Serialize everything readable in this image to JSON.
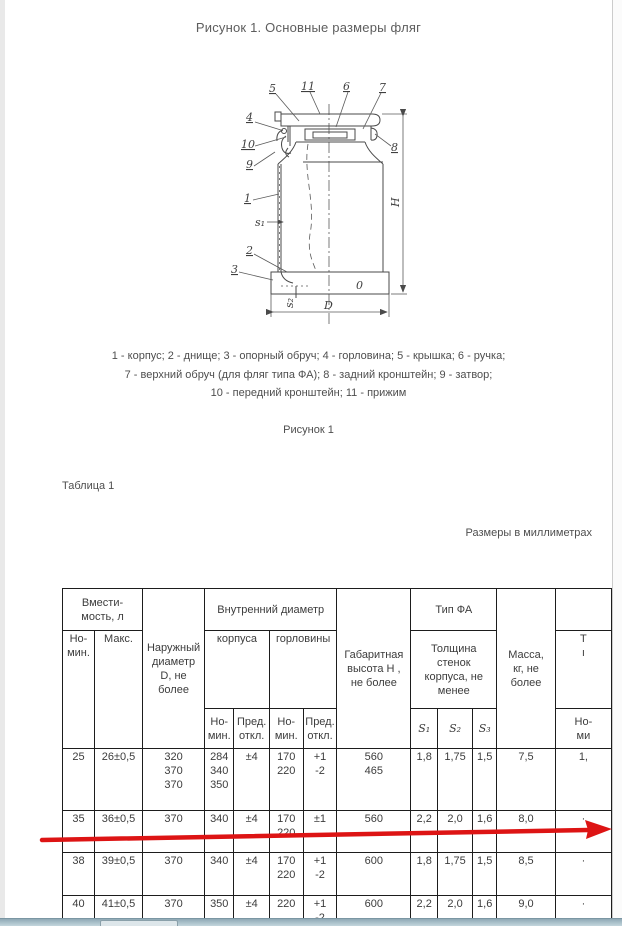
{
  "document": {
    "title": "Рисунок 1. Основные размеры фляг",
    "caption_lines": [
      "1 - корпус; 2 - днище; 3 - опорный обруч; 4 - горловина; 5 - крышка; 6 - ручка;",
      "7 - верхний обруч (для фляг типа ФА); 8 - задний кронштейн; 9 - затвор;",
      "10 - передний кронштейн; 11 - прижим"
    ],
    "figure_label": "Рисунок 1",
    "table_label": "Таблица 1",
    "units_note": "Размеры в миллиметрах"
  },
  "drawing": {
    "callouts": {
      "c1": "1",
      "c2": "2",
      "c3": "3",
      "c4": "4",
      "c5": "5",
      "c6": "6",
      "c7": "7",
      "c8": "8",
      "c9": "9",
      "c10": "10",
      "c11": "11"
    },
    "labels": {
      "s1": "s₁",
      "s2": "s₂",
      "d": "D",
      "h": "H",
      "zero": "0"
    }
  },
  "table": {
    "headers": {
      "capacity_group": "Вмести-\nмость, л",
      "nominal": "Но-\nмин.",
      "max": "Макс.",
      "outer_diameter": "Наружный\nдиаметр\nD, не\nболее",
      "inner_diameter_group": "Внутренний диаметр",
      "body": "корпуса",
      "neck": "горловины",
      "nominal_small": "Но-\nмин.",
      "deviation_small": "Пред.\nоткл.",
      "overall_height": "Габаритная\nвысота H ,\nне более",
      "type_fa": "Тип ФА",
      "wall_thickness": "Толщина\nстенок\nкорпуса, не\nменее",
      "s1": "S₁",
      "s2": "S₂",
      "s3": "S₃",
      "mass": "Масса,\nкг, не\nболее",
      "clipped_top": "",
      "clipped_mid": "Т\nı",
      "clipped_sub": "Но-\nми"
    },
    "rows": [
      {
        "cells": [
          "25",
          "26±0,5",
          "320\n370\n370",
          "284\n340\n350",
          "±4",
          "170\n220",
          "+1\n-2",
          "560\n465",
          "1,8",
          "1,75",
          "1,5",
          "7,5",
          "1,"
        ]
      },
      {
        "cells": [
          "35",
          "36±0,5",
          "370",
          "340",
          "±4",
          "170\n220",
          "±1",
          "560",
          "2,2",
          "2,0",
          "1,6",
          "8,0",
          "·"
        ]
      },
      {
        "cells": [
          "38",
          "39±0,5",
          "370",
          "340",
          "±4",
          "170\n220",
          "+1\n-2",
          "600",
          "1,8",
          "1,75",
          "1,5",
          "8,5",
          "·"
        ]
      },
      {
        "cells": [
          "40",
          "41±0,5",
          "370",
          "350",
          "±4",
          "220",
          "+1\n-2",
          "600",
          "2,2",
          "2,0",
          "1,6",
          "9,0",
          "·"
        ]
      }
    ]
  },
  "annotation": {
    "arrow_color": "#dd1414"
  }
}
